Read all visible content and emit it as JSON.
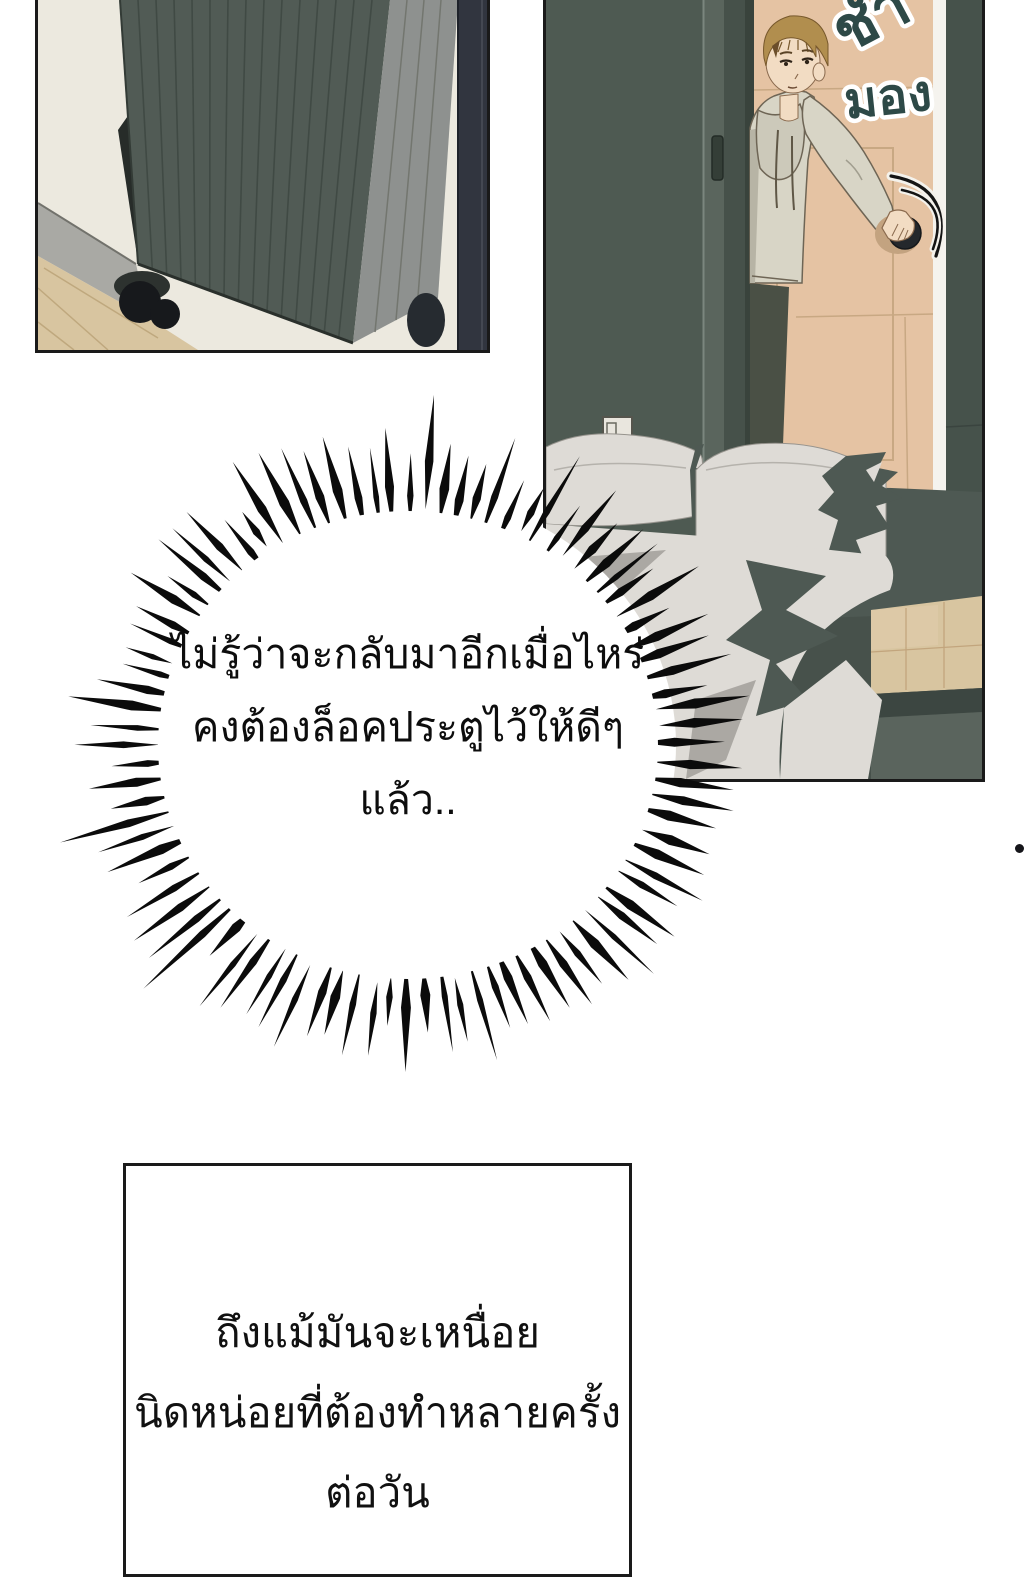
{
  "speech_bubble": {
    "lines": [
      "ไม่รู้ว่าจะกลับมาอีกเมื่อไหร่",
      "คงต้องล็อคประตูไว้ให้ดีๆ",
      "แล้ว.."
    ]
  },
  "caption_box": {
    "lines": [
      "ถึงแม้มันจะเหนื่อย",
      "นิดหน่อยที่ต้องทำหลายครั้ง",
      "ต่อวัน"
    ]
  },
  "sfx": {
    "top_partial": "ชำ",
    "look": "มอง"
  },
  "palette": {
    "ink": "#0b0b0b",
    "panelborder": "#1a1a1a",
    "cream": "#ece9df",
    "base": "#a9a9a4",
    "wood": "#d8c5a0",
    "case": "#515b55",
    "caseridge": "#3c4641",
    "caseside": "#8e918f",
    "navy": "#31353f",
    "wallteal": "#4e5a52",
    "wallteal2": "#5a655d",
    "tan": "#e5c3a3",
    "seam": "#c8a883",
    "hoodie": "#d8d5c6",
    "hoodieshadow": "#b7b4a5",
    "skin": "#f2dcc3",
    "hair": "#b18e4e",
    "hairdark": "#77582c",
    "pants": "#4a5045",
    "bedwhite": "#dedbd6",
    "bedgray": "#aba8a3",
    "beddark": "#4e5953",
    "sfxfill": "#2d4947",
    "sfxstroke": "#ffffff"
  }
}
